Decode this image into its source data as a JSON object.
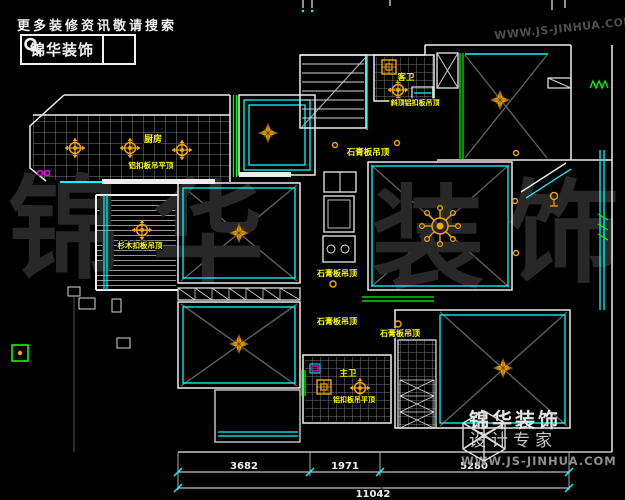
{
  "header": {
    "tagline": "更多装修资讯敬请搜索",
    "brand": "锦华装饰"
  },
  "watermark": {
    "url": "WWW.JS-JINHUA.COM",
    "chars": [
      "锦",
      "华",
      "装",
      "饰"
    ]
  },
  "footer_logo": {
    "brand": "锦华装饰",
    "subtitle": "设计专家",
    "url": "WWW.JS-JINHUA.COM"
  },
  "plan": {
    "rooms": {
      "kitchen": {
        "name": "厨房",
        "ceiling": "铝扣板吊平顶"
      },
      "balcony": {
        "ceiling": "杉木扣板吊顶"
      },
      "hall": {
        "ceiling": "石膏板吊顶"
      },
      "bath_top": {
        "name": "客卫",
        "ceiling": "斜顶铝扣板吊顶"
      },
      "corridor_upper": {
        "ceiling": "石膏板吊顶"
      },
      "corridor_lower": {
        "ceiling": "石膏板吊顶"
      },
      "room_bottomright": {
        "ceiling": "石膏板吊顶"
      },
      "bath_bottom": {
        "name": "主卫",
        "ceiling": "铝扣板吊平顶"
      }
    },
    "dimensions": {
      "seg1": "3682",
      "seg2": "1971",
      "seg3": "5280",
      "total": "11042"
    }
  },
  "colors": {
    "wall": "#ededed",
    "cyan": "#00ffff",
    "green": "#00ff00",
    "ornament": "#f5a800",
    "label": "#ffff00",
    "grid": "#7f7f7f",
    "magenta": "#ff00ff"
  }
}
